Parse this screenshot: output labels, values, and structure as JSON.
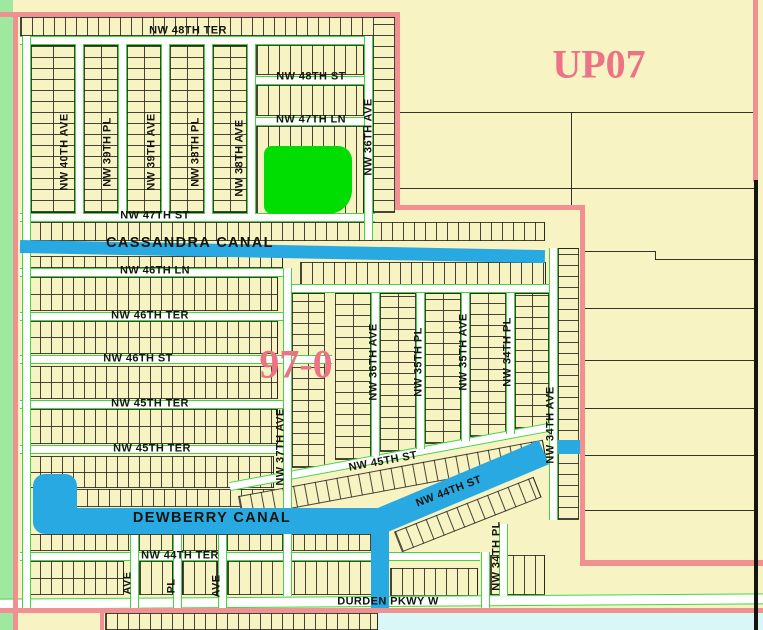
{
  "map": {
    "zones": {
      "up07": "UP07",
      "section_97_0": "97-0"
    },
    "canals": {
      "cassandra": "CASSANDRA CANAL",
      "dewberry": "DEWBERRY CANAL"
    },
    "streets": {
      "nw_48th_ter": "NW 48TH TER",
      "nw_48th_st": "NW 48TH ST",
      "nw_47th_ln": "NW 47TH LN",
      "nw_47th_st": "NW 47TH ST",
      "nw_46th_ln": "NW 46TH LN",
      "nw_46th_ter": "NW 46TH TER",
      "nw_46th_st": "NW 46TH ST",
      "nw_45th_ter_1": "NW 45TH TER",
      "nw_45th_ter_2": "NW 45TH TER",
      "nw_45th_st": "NW 45TH ST",
      "nw_44th_ter": "NW 44TH TER",
      "nw_44th_st": "NW 44TH ST",
      "durden_pkwy_w": "DURDEN PKWY W",
      "nw_40th_ave": "NW 40TH AVE",
      "nw_39th_pl": "NW 39TH PL",
      "nw_39th_ave": "NW 39TH AVE",
      "nw_38th_pl": "NW 38TH PL",
      "nw_38th_ave": "NW 38TH AVE",
      "nw_37th_ave": "NW 37TH AVE",
      "nw_36th_ave_north": "NW 36TH AVE",
      "nw_36th_ave_south": "NW 36TH AVE",
      "nw_35th_pl": "NW 35TH PL",
      "nw_35th_ave": "NW 35TH AVE",
      "nw_34th_pl": "NW 34TH PL",
      "nw_34th_pl_south": "NW 34TH PL",
      "nw_34th_ave": "NW 34TH AVE",
      "partial_ave_1": "AVE",
      "partial_pl": "PL",
      "partial_ave_2": "AVE"
    },
    "colors": {
      "parcel_fill": "#f8f3c3",
      "water_blue": "#29a9e1",
      "boundary_pink": "#f19090",
      "zone_text_pink": "#ee7285",
      "selected_parcel_green": "#00dd00",
      "greenway_strip": "#9fe89f",
      "flood_cyan": "#d9f7f7",
      "street_edge_green": "#44d544"
    }
  }
}
